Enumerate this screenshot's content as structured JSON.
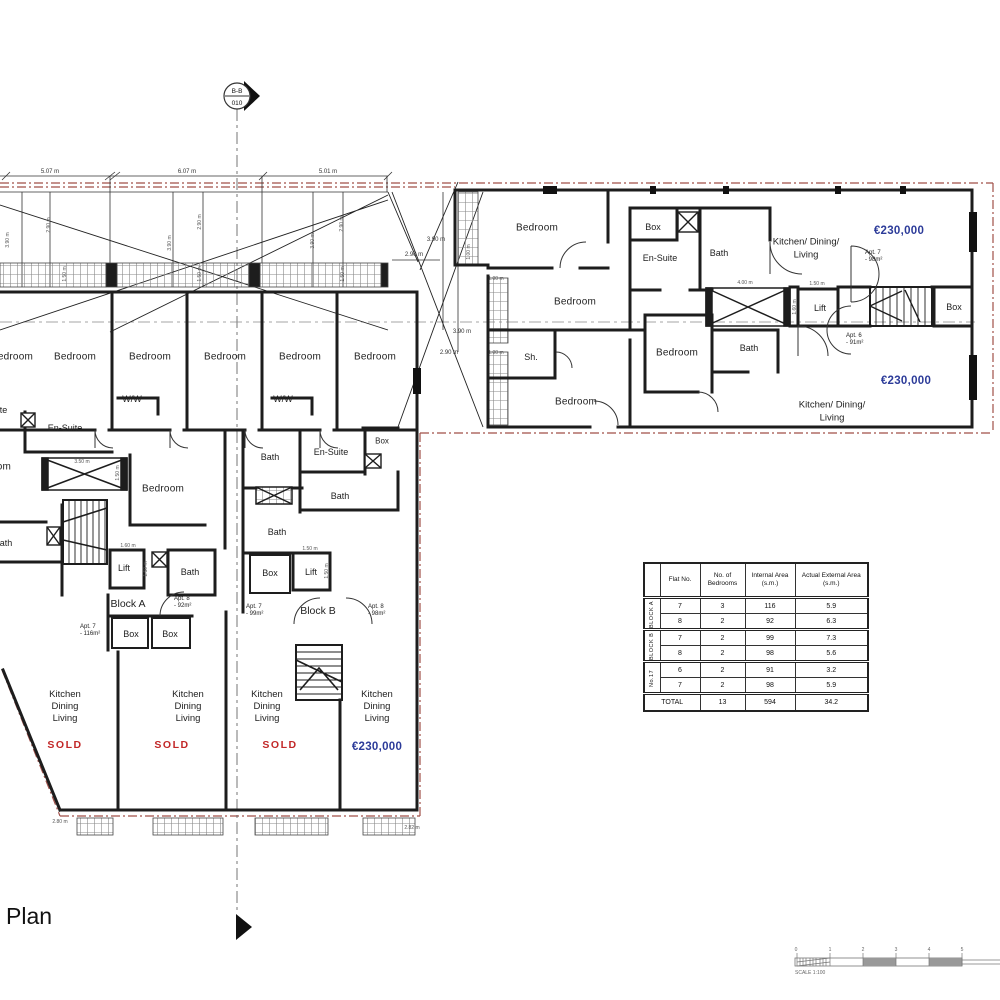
{
  "drawing": {
    "title": "Plan",
    "section_marker": {
      "code": "B-B",
      "sheet": "010"
    },
    "scale": {
      "label": "SCALE 1:100",
      "ticks": [
        "0",
        "1",
        "2",
        "3",
        "4",
        "5"
      ]
    }
  },
  "labels": {
    "bedroom": "Bedroom",
    "bath": "Bath",
    "en_suite": "En-Suite",
    "box": "Box",
    "lift": "Lift",
    "ww": "W/W",
    "shower": "Sh.",
    "kitchen": "Kitchen",
    "dining": "Dining",
    "living": "Living",
    "kdl_line1": "Kitchen/ Dining/",
    "kdl_line2": "Living",
    "block_a": "Block A",
    "block_b": "Block B",
    "sold": "SOLD",
    "price": "€230,000"
  },
  "apartments": {
    "block_a_apt7": {
      "line1": "Apt. 7",
      "line2": "- 116m²"
    },
    "block_a_apt8": {
      "line1": "Apt. 8",
      "line2": "- 92m²"
    },
    "block_b_apt7": {
      "line1": "Apt. 7",
      "line2": "- 99m²"
    },
    "block_b_apt8": {
      "line1": "Apt. 8",
      "line2": "- 98m²"
    },
    "no17_apt6": {
      "line1": "Apt. 6",
      "line2": "- 91m²"
    },
    "no17_apt7": {
      "line1": "Apt. 7",
      "line2": "- 98m²"
    }
  },
  "dimensions": {
    "d507": "5.07 m",
    "d607": "6.07 m",
    "d501": "5.01 m",
    "d390": "3.90 m",
    "d290": "2.90 m",
    "d350": "3.50 m",
    "d400": "4.00 m",
    "d150": "1.50 m",
    "d160": "1.60 m",
    "d100": "1.00 m",
    "d280": "2.80 m",
    "d282": "2.82 m"
  },
  "table": {
    "headers": {
      "flat": "Flat No.",
      "bedrooms": "No. of Bedrooms",
      "internal": "Internal Area (s.m.)",
      "external": "Actual External Area (s.m.)"
    },
    "groups": [
      {
        "name": "BLOCK A",
        "rows": [
          {
            "flat": "7",
            "bedrooms": "3",
            "internal": "116",
            "external": "5.9"
          },
          {
            "flat": "8",
            "bedrooms": "2",
            "internal": "92",
            "external": "6.3"
          }
        ]
      },
      {
        "name": "BLOCK B",
        "rows": [
          {
            "flat": "7",
            "bedrooms": "2",
            "internal": "99",
            "external": "7.3"
          },
          {
            "flat": "8",
            "bedrooms": "2",
            "internal": "98",
            "external": "5.6"
          }
        ]
      },
      {
        "name": "No.17",
        "rows": [
          {
            "flat": "6",
            "bedrooms": "2",
            "internal": "91",
            "external": "3.2"
          },
          {
            "flat": "7",
            "bedrooms": "2",
            "internal": "98",
            "external": "5.9"
          }
        ]
      }
    ],
    "total": {
      "label": "TOTAL",
      "bedrooms": "13",
      "internal": "594",
      "external": "34.2"
    }
  },
  "colors": {
    "price_blue": "#2c3b99",
    "sold_red": "#c22828",
    "boundary_red": "#a04f48",
    "wall_black": "#1d1d1d"
  }
}
